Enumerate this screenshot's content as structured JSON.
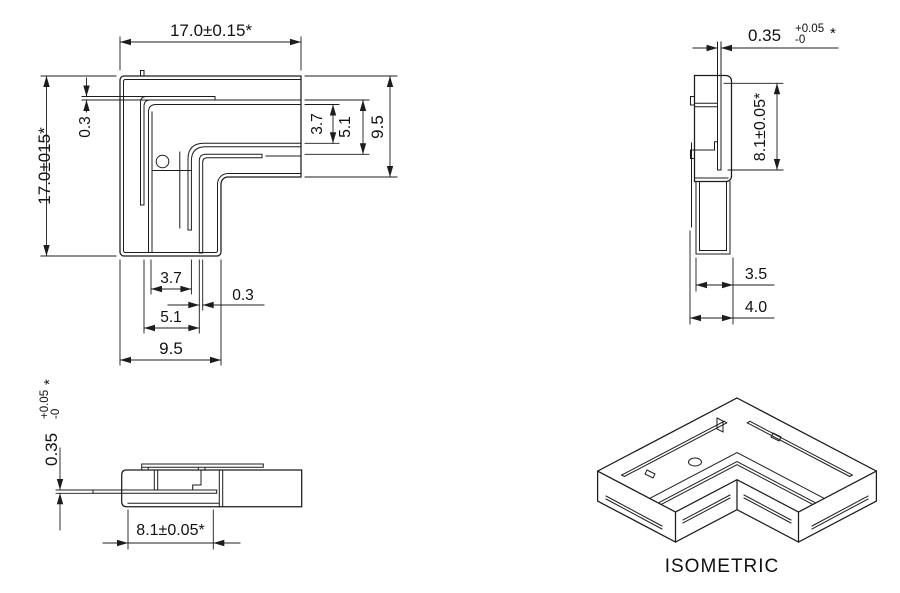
{
  "front_view": {
    "dim_width_top": "17.0±0.15*",
    "dim_height_left": "17.0±015*",
    "dim_slot_left": "0.3",
    "dim_right_inner": "3.7",
    "dim_right_mid": "5.1",
    "dim_right_outer": "9.5",
    "dim_bottom_inner": "3.7",
    "dim_bottom_slot": "0.3",
    "dim_bottom_mid": "5.1",
    "dim_bottom_outer": "9.5"
  },
  "side_view": {
    "dim_pin_value": "0.35",
    "dim_pin_tol_plus": "+0.05",
    "dim_pin_tol_minus": "-0",
    "dim_pin_star": "*",
    "dim_height": "8.1±0.05*",
    "dim_width_inner": "3.5",
    "dim_width_outer": "4.0"
  },
  "bottom_view": {
    "dim_pin_value": "0.35",
    "dim_pin_tol_plus": "+0.05",
    "dim_pin_tol_minus": "-0",
    "dim_pin_star": "*",
    "dim_width": "8.1±0.05*"
  },
  "isometric_view": {
    "label": "ISOMETRIC"
  }
}
